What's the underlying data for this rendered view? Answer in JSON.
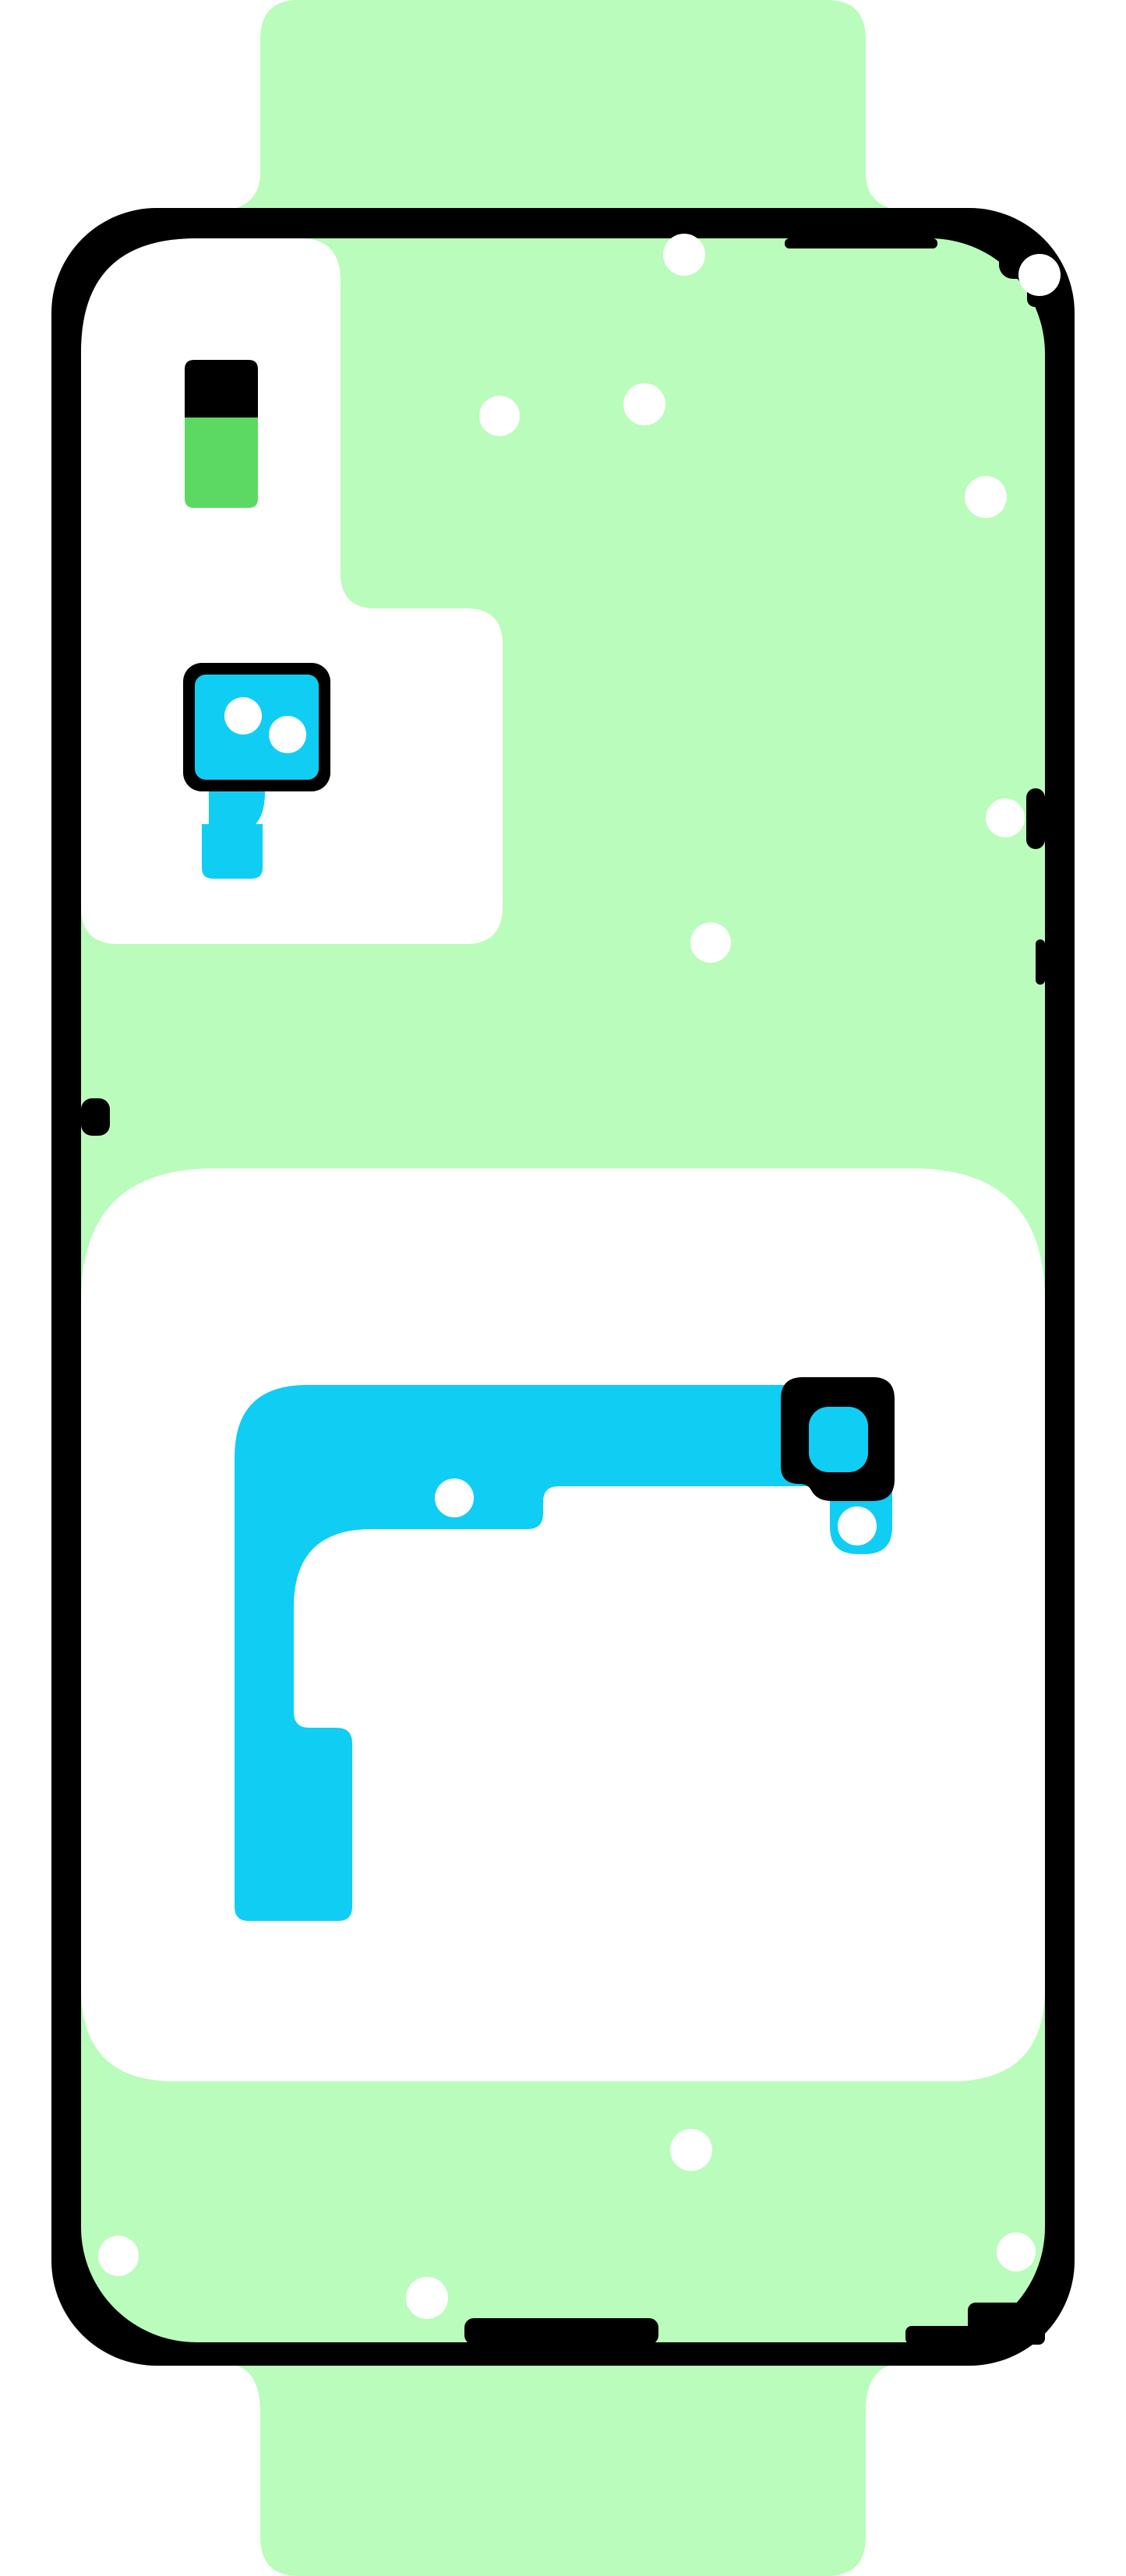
{
  "colors": {
    "background_white": "#ffffff",
    "sheet_green": "#bafcbb",
    "pull_tab_green": "#5cd963",
    "adhesive_cyan": "#10cdf3",
    "outline_black": "#000000",
    "hole_white": "#ffffff"
  }
}
